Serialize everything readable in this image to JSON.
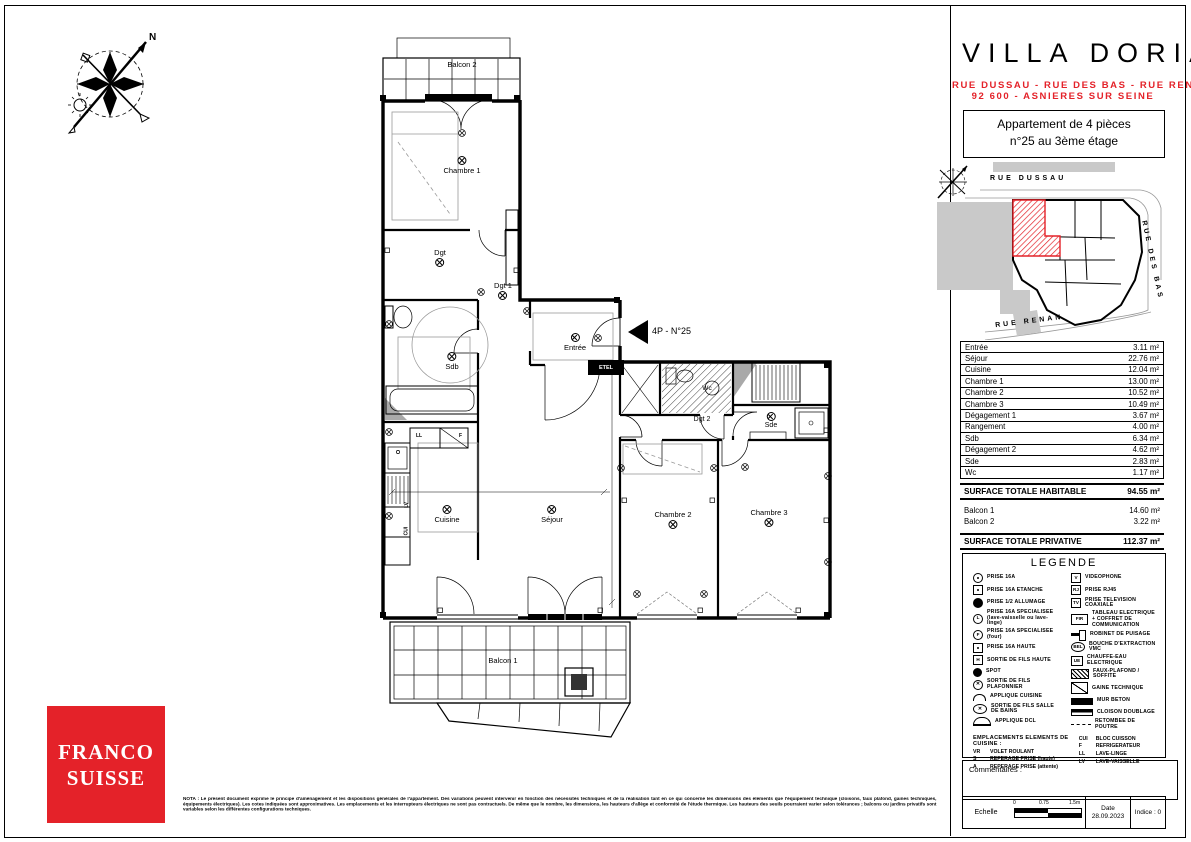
{
  "colors": {
    "accent": "#e42229"
  },
  "header": {
    "title": "VILLA DORIA",
    "address_line1": "RUE DUSSAU - RUE DES BAS - RUE RENAN",
    "address_line2": "92 600 - ASNIERES SUR SEINE",
    "apartment_line1": "Appartement de 4 pièces",
    "apartment_line2": "n°25 au 3ème étage"
  },
  "site_plan": {
    "street_top": "RUE DUSSAU",
    "street_right": "RUE DES BAS",
    "street_bottom": "RUE RENAN"
  },
  "plan": {
    "entrance_label": "4P - N°25",
    "etel_label": "ETEL",
    "rooms": [
      {
        "label": "Balcon 2"
      },
      {
        "label": "Chambre 1"
      },
      {
        "label": "Dgt"
      },
      {
        "label": "Dgt 1"
      },
      {
        "label": "Entrée"
      },
      {
        "label": "Sdb"
      },
      {
        "label": "Cuisine"
      },
      {
        "label": "Séjour"
      },
      {
        "label": "Wc"
      },
      {
        "label": "Dgt 2"
      },
      {
        "label": "Sde"
      },
      {
        "label": "Chambre 2"
      },
      {
        "label": "Chambre 3"
      },
      {
        "label": "Balcon 1"
      }
    ],
    "kitchen_marks": {
      "m1": "LL",
      "m2": "F",
      "m3": "LV",
      "m4": "CUI"
    }
  },
  "surfaces": {
    "rows": [
      {
        "label": "Entrée",
        "value": "3.11 m²"
      },
      {
        "label": "Séjour",
        "value": "22.76 m²"
      },
      {
        "label": "Cuisine",
        "value": "12.04 m²"
      },
      {
        "label": "Chambre 1",
        "value": "13.00 m²"
      },
      {
        "label": "Chambre 2",
        "value": "10.52 m²"
      },
      {
        "label": "Chambre 3",
        "value": "10.49 m²"
      },
      {
        "label": "Dégagement 1",
        "value": "3.67 m²"
      },
      {
        "label": "Rangement",
        "value": "4.00 m²"
      },
      {
        "label": "Sdb",
        "value": "6.34 m²"
      },
      {
        "label": "Dégagement 2",
        "value": "4.62 m²"
      },
      {
        "label": "Sde",
        "value": "2.83 m²"
      },
      {
        "label": "Wc",
        "value": "1.17 m²"
      }
    ],
    "total_habitable_label": "SURFACE TOTALE HABITABLE",
    "total_habitable_value": "94.55 m²",
    "balcony_rows": [
      {
        "label": "Balcon 1",
        "value": "14.60 m²"
      },
      {
        "label": "Balcon 2",
        "value": "3.22 m²"
      }
    ],
    "total_privative_label": "SURFACE TOTALE PRIVATIVE",
    "total_privative_value": "112.37 m²"
  },
  "legend": {
    "title": "LEGENDE",
    "left_items": [
      {
        "icon_text": "",
        "label": "PRISE 16A"
      },
      {
        "icon_text": "",
        "label": "PRISE 16A ETANCHE"
      },
      {
        "icon_text": "",
        "label": "PRISE 1/2 ALLUMAGE"
      },
      {
        "icon_text": "L",
        "label": "PRISE 16A SPECIALISEE (lave-vaisselle ou lave-linge)"
      },
      {
        "icon_text": "F",
        "label": "PRISE 16A SPECIALISEE (four)"
      },
      {
        "icon_text": "",
        "label": "PRISE 16A HAUTE"
      },
      {
        "icon_text": "H",
        "label": "SORTIE DE FILS HAUTE"
      },
      {
        "icon_text": "",
        "label": "SPOT"
      },
      {
        "icon_text": "",
        "label": "SORTIE DE FILS PLAFONNIER"
      },
      {
        "icon_text": "",
        "label": "APPLIQUE CUISINE"
      },
      {
        "icon_text": "",
        "label": "SORTIE DE FILS SALLE DE BAINS"
      },
      {
        "icon_text": "",
        "label": "APPLIQUE DCL"
      }
    ],
    "right_items": [
      {
        "icon_text": "V",
        "label": "VIDEOPHONE"
      },
      {
        "icon_text": "RJ",
        "label": "PRISE RJ45"
      },
      {
        "icon_text": "TV",
        "label": "PRISE TELEVISION COAXIALE"
      },
      {
        "icon_text": "FIR",
        "label": "TABLEAU ELECTRIQUE + COFFRET DE COMMUNICATION"
      },
      {
        "icon_text": "",
        "label": "ROBINET DE PUISAGE"
      },
      {
        "icon_text": "BEL",
        "label": "BOUCHE D'EXTRACTION VMC"
      },
      {
        "icon_text": "UE",
        "label": "CHAUFFE-EAU ELECTRIQUE"
      },
      {
        "icon_text": "",
        "label": "FAUX-PLAFOND / SOFFITE"
      },
      {
        "icon_text": "",
        "label": "GAINE TECHNIQUE"
      },
      {
        "icon_text": "",
        "label": "MUR BETON"
      },
      {
        "icon_text": "",
        "label": "CLOISON DOUBLAGE"
      },
      {
        "icon_text": "",
        "label": "RETOMBEE DE POUTRE"
      }
    ],
    "kitchen_header": "EMPLACEMENTS ELEMENTS DE CUISINE :",
    "kitchen_left": [
      {
        "code": "VR",
        "label": "VOLET ROULANT"
      },
      {
        "code": "S",
        "label": "REPERAGE PRISE (haute)"
      },
      {
        "code": "A",
        "label": "REPERAGE PRISE (attente)"
      }
    ],
    "kitchen_right": [
      {
        "code": "CUI",
        "label": "BLOC CUISSON"
      },
      {
        "code": "F",
        "label": "REFRIGERATEUR"
      },
      {
        "code": "LL",
        "label": "LAVE-LINGE"
      },
      {
        "code": "LV",
        "label": "LAVE-VAISSELLE"
      }
    ]
  },
  "commentaires": {
    "label": "Commentaires :"
  },
  "footer": {
    "echelle_label": "Echelle",
    "scale_0": "0",
    "scale_mid": "0.75",
    "scale_end": "1.5m",
    "date_label": "Date",
    "date_value": "28.09.2023",
    "indice": "Indice : 0"
  },
  "nota": "NOTA : Le présent document exprime le principe d'aménagement et les dispositions générales de l'appartement. Des variations peuvent intervenir en fonction des nécessités techniques et de la réalisation tant en ce qui concerne les dimensions des éléments que l'équipement technique (cloisons, faux plafond, gaines techniques, équipements électriques). Les cotes indiquées sont approximatives. Les emplacements et les interrupteurs électriques ne sont pas contractuels. De même que le nombre, les dimensions, les hauteurs d'allège et conformité de l'étude thermique. Les hauteurs des seuils pourraient varier selon tolérances ; balcons ou jardins privatifs sont variables selon les différentes configurations techniques.",
  "logo": {
    "line1": "FRANCO",
    "line2": "SUISSE"
  },
  "compass": {
    "north_label": "N"
  }
}
